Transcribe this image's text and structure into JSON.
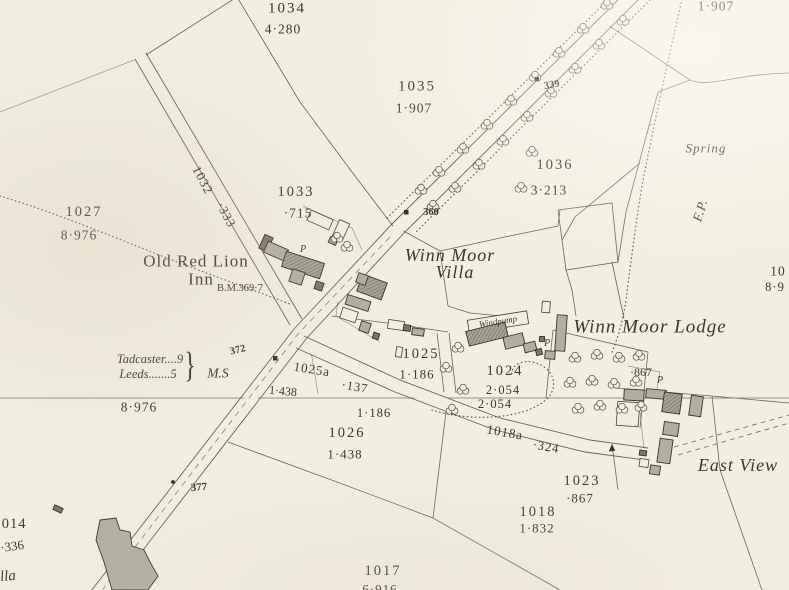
{
  "map": {
    "kind": "historic-ordnance-survey-sheet",
    "colors": {
      "paper": "#f2eee1",
      "ink": "#3b372c",
      "line": "#57534a",
      "building_fill": "#b2aea0",
      "building_dark": "#7b7769"
    }
  },
  "labels": [
    {
      "name": "parcel-1034",
      "text": "1034",
      "x": 287,
      "y": 9,
      "size": 15,
      "ls": 2
    },
    {
      "name": "area-1034",
      "text": "4·280",
      "x": 283,
      "y": 29,
      "size": 13.5,
      "ls": 1
    },
    {
      "name": "area-1907-topright",
      "text": "1·907",
      "x": 716,
      "y": 6,
      "size": 13.5,
      "ls": 1
    },
    {
      "name": "parcel-1035",
      "text": "1035",
      "x": 417,
      "y": 87,
      "size": 15,
      "ls": 2
    },
    {
      "name": "area-1035",
      "text": "1·907",
      "x": 414,
      "y": 108,
      "size": 13.5,
      "ls": 1
    },
    {
      "name": "number-339",
      "text": "339",
      "x": 552,
      "y": 86,
      "size": 10.5,
      "rot": -10,
      "weight": 600
    },
    {
      "name": "parcel-1036",
      "text": "1036",
      "x": 555,
      "y": 165,
      "size": 14.5,
      "ls": 2
    },
    {
      "name": "area-1036",
      "text": "3·213",
      "x": 549,
      "y": 190,
      "size": 13.5,
      "ls": 1
    },
    {
      "name": "spring-label",
      "text": "Spring",
      "x": 706,
      "y": 148,
      "size": 13,
      "italic": true,
      "ls": 1
    },
    {
      "name": "footpath-label",
      "text": "F.P.",
      "x": 700,
      "y": 210,
      "size": 13,
      "italic": true,
      "rot": -73,
      "ls": 1
    },
    {
      "name": "road-1032",
      "text": "1032",
      "x": 203,
      "y": 180,
      "size": 13,
      "rot": 62,
      "ls": 1
    },
    {
      "name": "road-1032-area",
      "text": "·333",
      "x": 226,
      "y": 215,
      "size": 12.5,
      "rot": 62,
      "ls": 1
    },
    {
      "name": "parcel-1033",
      "text": "1033",
      "x": 296,
      "y": 192,
      "size": 14.5,
      "ls": 2
    },
    {
      "name": "area-1033",
      "text": "·715",
      "x": 298,
      "y": 213,
      "size": 13.5,
      "ls": 1
    },
    {
      "name": "parcel-1027",
      "text": "1027",
      "x": 84,
      "y": 212,
      "size": 14.5,
      "ls": 2
    },
    {
      "name": "area-1027",
      "text": "8·976",
      "x": 79,
      "y": 235,
      "size": 13.5,
      "ls": 1
    },
    {
      "name": "old-red-lion-inn-line1",
      "text": "Old Red Lion",
      "x": 196,
      "y": 261,
      "size": 17,
      "ls": 1
    },
    {
      "name": "old-red-lion-inn-line2",
      "text": "Inn",
      "x": 201,
      "y": 279,
      "size": 17,
      "ls": 1
    },
    {
      "name": "benchmark-369-7",
      "text": "B.M.369·7",
      "x": 240,
      "y": 289,
      "size": 10.5
    },
    {
      "name": "number-360",
      "text": "360",
      "x": 431,
      "y": 213,
      "size": 10.5,
      "weight": 600
    },
    {
      "name": "winn-moor-villa-line1",
      "text": "Winn Moor",
      "x": 450,
      "y": 255,
      "size": 18,
      "italic": true,
      "ls": 1
    },
    {
      "name": "winn-moor-villa-line2",
      "text": "Villa",
      "x": 455,
      "y": 272,
      "size": 18,
      "italic": true,
      "ls": 1
    },
    {
      "name": "windpump-label",
      "text": "Windpump",
      "x": 498,
      "y": 322,
      "size": 9,
      "italic": true,
      "rot": -9
    },
    {
      "name": "winn-moor-lodge",
      "text": "Winn Moor Lodge",
      "x": 650,
      "y": 327,
      "size": 19,
      "italic": true,
      "ls": 1
    },
    {
      "name": "milestone-tadcaster",
      "text": "Tadcaster....9",
      "x": 150,
      "y": 359,
      "size": 12.5,
      "italic": true
    },
    {
      "name": "milestone-leeds",
      "text": "Leeds.......5",
      "x": 148,
      "y": 374,
      "size": 12.5,
      "italic": true
    },
    {
      "name": "milestone-brace",
      "text": "}",
      "x": 190,
      "y": 366,
      "size": 24,
      "sy": 1.5
    },
    {
      "name": "milestone-ms",
      "text": "M.S",
      "x": 218,
      "y": 373,
      "size": 13.5,
      "italic": true
    },
    {
      "name": "number-372",
      "text": "372",
      "x": 238,
      "y": 351,
      "size": 10.5,
      "rot": -14,
      "weight": 600
    },
    {
      "name": "parcel-1025",
      "text": "1025",
      "x": 421,
      "y": 354,
      "size": 14.5,
      "ls": 2
    },
    {
      "name": "area-1025",
      "text": "1·186",
      "x": 417,
      "y": 374,
      "size": 13,
      "ls": 1
    },
    {
      "name": "road-1025a",
      "text": "1025a",
      "x": 312,
      "y": 369,
      "size": 13,
      "rot": 9,
      "ls": 1
    },
    {
      "name": "road-1025a-area",
      "text": "·137",
      "x": 355,
      "y": 387,
      "size": 12.5,
      "rot": 9,
      "ls": 1
    },
    {
      "name": "area-1438-west",
      "text": "1·438",
      "x": 283,
      "y": 391,
      "size": 12,
      "rot": 5
    },
    {
      "name": "area-8976-below-line",
      "text": "8·976",
      "x": 139,
      "y": 407,
      "size": 13.5,
      "ls": 1
    },
    {
      "name": "parcel-1024",
      "text": "1024",
      "x": 505,
      "y": 371,
      "size": 14.5,
      "ls": 2
    },
    {
      "name": "area-1024-a",
      "text": "2·054",
      "x": 503,
      "y": 390,
      "size": 12.5,
      "ls": 1
    },
    {
      "name": "area-1024-b",
      "text": "2·054",
      "x": 495,
      "y": 404,
      "size": 12.5,
      "ls": 1
    },
    {
      "name": "area-867-orchard",
      "text": "·867",
      "x": 641,
      "y": 372,
      "size": 12
    },
    {
      "name": "pump-p-lodge-east",
      "text": "P",
      "x": 660,
      "y": 381,
      "size": 10,
      "italic": true
    },
    {
      "name": "pump-p-lodge-west",
      "text": "P",
      "x": 547,
      "y": 344,
      "size": 10,
      "italic": true
    },
    {
      "name": "pump-p-inn",
      "text": "P",
      "x": 303,
      "y": 250,
      "size": 10,
      "italic": true
    },
    {
      "name": "area-1186-below-line",
      "text": "1·186",
      "x": 374,
      "y": 413,
      "size": 12.5,
      "ls": 1
    },
    {
      "name": "parcel-1026",
      "text": "1026",
      "x": 347,
      "y": 433,
      "size": 14.5,
      "ls": 2
    },
    {
      "name": "area-1026",
      "text": "1·438",
      "x": 345,
      "y": 454,
      "size": 13,
      "ls": 1
    },
    {
      "name": "road-1018a",
      "text": "1018a",
      "x": 505,
      "y": 432,
      "size": 13,
      "rot": 10,
      "ls": 1
    },
    {
      "name": "road-1018a-area",
      "text": "·324",
      "x": 546,
      "y": 447,
      "size": 12.5,
      "rot": 10,
      "ls": 1
    },
    {
      "name": "east-view",
      "text": "East View",
      "x": 738,
      "y": 465,
      "size": 18,
      "italic": true,
      "ls": 1
    },
    {
      "name": "parcel-1023",
      "text": "1023",
      "x": 582,
      "y": 481,
      "size": 14.5,
      "ls": 2
    },
    {
      "name": "area-1023",
      "text": "·867",
      "x": 580,
      "y": 498,
      "size": 13,
      "ls": 1
    },
    {
      "name": "parcel-1018",
      "text": "1018",
      "x": 538,
      "y": 512,
      "size": 14.5,
      "ls": 2
    },
    {
      "name": "area-1018",
      "text": "1·832",
      "x": 537,
      "y": 528,
      "size": 13,
      "ls": 1
    },
    {
      "name": "parcel-1017",
      "text": "1017",
      "x": 383,
      "y": 571,
      "size": 14.5,
      "ls": 2
    },
    {
      "name": "area-1017-clipped",
      "text": "6·916",
      "x": 380,
      "y": 589,
      "size": 13,
      "ls": 1
    },
    {
      "name": "parcel-1014-clipped",
      "text": "1014",
      "x": 10,
      "y": 524,
      "size": 14.5,
      "ls": 1
    },
    {
      "name": "area-1014-clipped",
      "text": "·336",
      "x": 12,
      "y": 546,
      "size": 13,
      "rot": -8
    },
    {
      "name": "name-fragment-bottom-left",
      "text": "lla",
      "x": 8,
      "y": 577,
      "size": 15,
      "italic": true,
      "rot": -6
    },
    {
      "name": "number-377",
      "text": "377",
      "x": 199,
      "y": 488,
      "size": 11,
      "weight": 600,
      "rot": -4
    },
    {
      "name": "parcel-fragment-right-edge",
      "text": "10",
      "x": 778,
      "y": 271,
      "size": 13.5,
      "ls": 1
    },
    {
      "name": "area-fragment-right-edge",
      "text": "8·9",
      "x": 775,
      "y": 287,
      "size": 12.5,
      "ls": 1
    }
  ]
}
